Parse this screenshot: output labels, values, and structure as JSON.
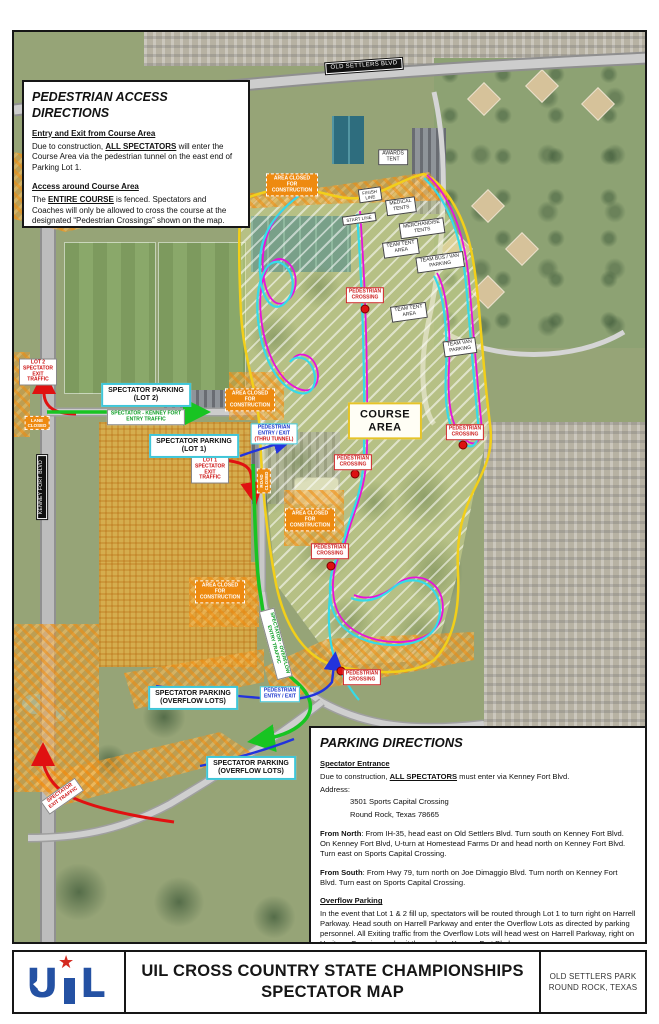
{
  "banner": {
    "logo_u": "U",
    "logo_star": "★",
    "logo_l": "L",
    "title_line1": "UIL CROSS COUNTRY STATE CHAMPIONSHIPS",
    "title_line2": "SPECTATOR MAP",
    "location_line1": "OLD SETTLERS PARK",
    "location_line2": "ROUND ROCK, TEXAS"
  },
  "pedestrian_box": {
    "title": "PEDESTRIAN ACCESS DIRECTIONS",
    "s1_head": "Entry and Exit from Course Area",
    "s1_pre": "Due to construction, ",
    "s1_bold": "ALL SPECTATORS",
    "s1_post": " will enter the Course Area via the pedestrian tunnel on the east end of Parking Lot 1.",
    "s2_head": "Access around Course Area",
    "s2_pre": "The ",
    "s2_bold": "ENTIRE COURSE",
    "s2_post": " is fenced.  Spectators and Coaches will only be allowed to cross the course at the designated “Pedestrian Crossings” shown on the map."
  },
  "parking_box": {
    "title": "PARKING DIRECTIONS",
    "s1_head": "Spectator Entrance",
    "s1_pre": "Due to construction, ",
    "s1_bold": "ALL SPECTATORS",
    "s1_post": " must enter via Kenney Fort Blvd.",
    "address_label": "Address:",
    "address_line1": "3501 Sports Capital Crossing",
    "address_line2": "Round Rock, Texas 78665",
    "north_label": "From North",
    "north_text": ": From IH-35, head east on Old Settlers Blvd.  Turn south on Kenney Fort Blvd. On Kenney Fort Blvd, U-turn at Homestead Farms Dr and head north on Kenney Fort Blvd. Turn east on Sports Capital Crossing.",
    "south_label": "From South",
    "south_text": ": From Hwy 79, turn north on Joe Dimaggio Blvd.  Turn north on Kenney Fort Blvd. Turn east on Sports Capital Crossing.",
    "overflow_head": "Overflow Parking",
    "overflow_text": "In the event that Lot 1 & 2 fill up, spectators will be routed through Lot 1 to turn right on Harrell Parkway.  Head south on Harrell Parkway and enter the Overflow Lots as directed by parking personnel.   All Exiting traffic from the Overflow Lots will head west on Harrell Parkway, right on Heritage Crossing and exit the park on Kenney Fort Blvd."
  },
  "map": {
    "labels": {
      "old_settlers_blvd": "OLD SETTLERS BLVD",
      "kenney_fort_blvd": "KENNEY FORT BLVD",
      "course_area": "COURSE\nAREA",
      "pedestrian_crossing": "PEDESTRIAN\nCROSSING",
      "area_closed": "AREA CLOSED\nFOR\nCONSTRUCTION",
      "awards_tent": "AWARDS\nTENT",
      "finish_line": "FINISH\nLINE",
      "start_line": "START LINE",
      "medical_tents": "MEDICAL\nTENTS",
      "merchandise_tents": "MERCHANDISE\nTENTS",
      "team_tent_area": "TEAM TENT\nAREA",
      "team_bus_van_parking": "TEAM BUS / VAN\nPARKING",
      "team_van_parking": "TEAM VAN\nPARKING",
      "spectator_parking_lot2": "SPECTATOR PARKING\n(LOT 2)",
      "spectator_parking_lot1": "SPECTATOR PARKING\n(LOT 1)",
      "spectator_parking_overflow": "SPECTATOR PARKING\n(OVERFLOW LOTS)",
      "lot2_exit": "LOT 2\nSPECTATOR\nEXIT\nTRAFFIC",
      "lot1_exit": "LOT 1\nSPECTATOR\nEXIT\nTRAFFIC",
      "kenney_entry": "SPECTATOR - KENNEY FORT\nENTRY TRAFFIC",
      "overflow_entry": "SPECTATOR - OVERFLOW\nENTRY TRAFFIC",
      "spectator_exit": "SPECTATOR\nEXIT TRAFFIC",
      "lane_closed": "LANE\nCLOSED",
      "road_closed": "ROAD\nCLOSED",
      "ped_entry_exit": "PEDESTRIAN\nENTRY / EXIT",
      "thru_tunnel": "(THRU TUNNEL)"
    },
    "colors": {
      "course_route_cyan": "#35dbe8",
      "course_route_magenta": "#e613dc",
      "course_boundary_yellow": "#f2cf1a",
      "construction_orange": "#ee8a10",
      "exit_route_red": "#e01111",
      "entry_route_green": "#18c422",
      "pedestrian_route_blue": "#2233dd",
      "crossing_marker_red": "#dd1111"
    }
  }
}
